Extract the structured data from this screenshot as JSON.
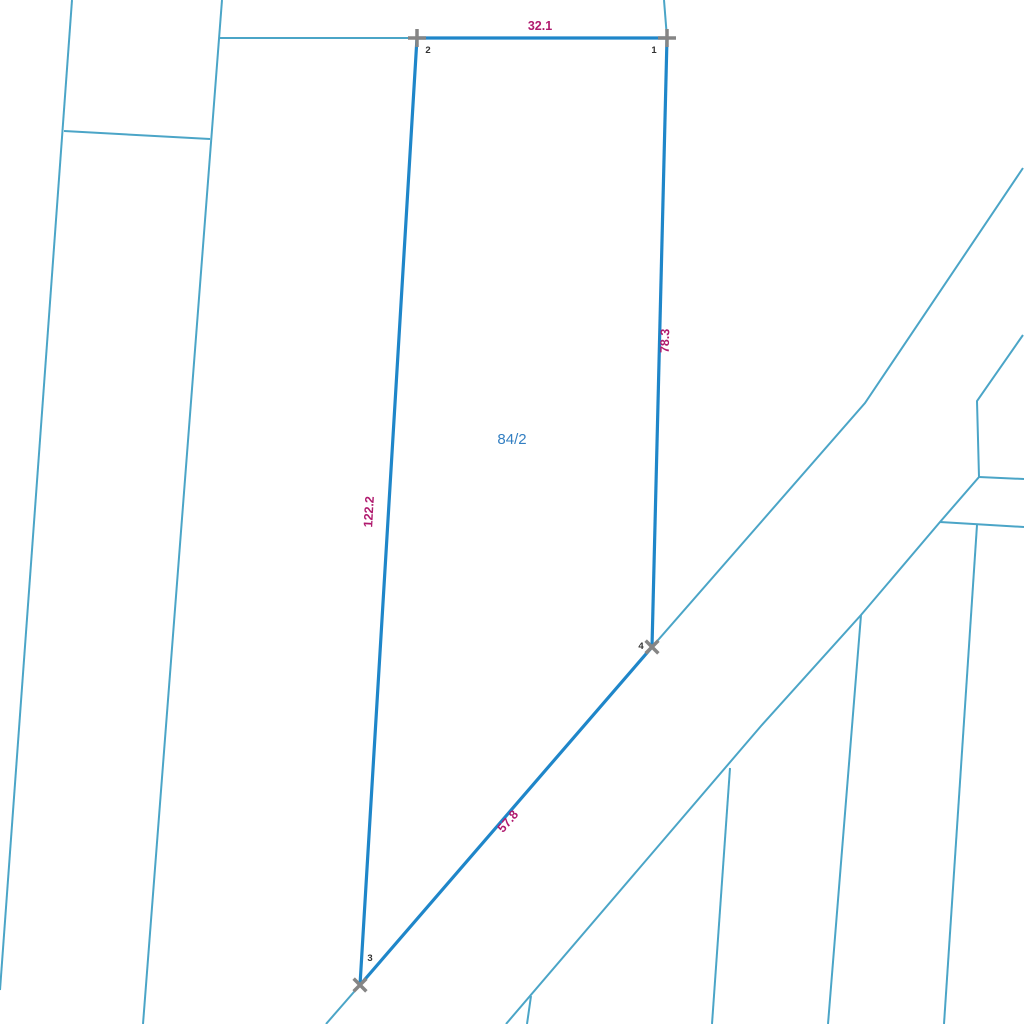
{
  "map": {
    "width": 1024,
    "height": 1024,
    "background_color": "#ffffff",
    "colors": {
      "parcel_edge": "#1f86c9",
      "cadastral_line": "#4ba5c7",
      "dimension_label": "#b01a6e",
      "parcel_number": "#337fc2",
      "vertex_marker": "#858585",
      "vertex_label": "#333333"
    },
    "stroke_widths": {
      "parcel_edge": 3.2,
      "cadastral_line": 2,
      "vertex_marker": 3.5
    },
    "parcel": {
      "number": "84/2",
      "number_label": {
        "x": 512,
        "y": 444
      },
      "vertices": [
        {
          "id": "1",
          "x": 667,
          "y": 38,
          "marker": "plus",
          "label_x": 654,
          "label_y": 53
        },
        {
          "id": "2",
          "x": 417,
          "y": 38,
          "marker": "plus",
          "label_x": 428,
          "label_y": 53
        },
        {
          "id": "3",
          "x": 360,
          "y": 985,
          "marker": "x",
          "label_x": 370,
          "label_y": 961
        },
        {
          "id": "4",
          "x": 652,
          "y": 647,
          "marker": "x",
          "label_x": 641,
          "label_y": 649
        }
      ],
      "edges": [
        {
          "from": "2",
          "to": "1",
          "length": "32.1",
          "label_x": 540,
          "label_y": 30,
          "label_rotation": 0
        },
        {
          "from": "1",
          "to": "4",
          "length": "78.3",
          "label_x": 669,
          "label_y": 341,
          "label_rotation": -88.6
        },
        {
          "from": "2",
          "to": "3",
          "length": "122.2",
          "label_x": 373,
          "label_y": 512,
          "label_rotation": -86.6
        },
        {
          "from": "3",
          "to": "4",
          "length": "57.8",
          "label_x": 511,
          "label_y": 824,
          "label_rotation": -49.2
        }
      ]
    },
    "cadastral_lines": [
      {
        "name": "boundary-line-west-outer",
        "points": [
          [
            72,
            0
          ],
          [
            0,
            990
          ]
        ]
      },
      {
        "name": "boundary-line-west-inner",
        "points": [
          [
            222,
            0
          ],
          [
            143,
            1024
          ]
        ]
      },
      {
        "name": "boundary-line-west-cross",
        "points": [
          [
            64,
            131
          ],
          [
            210,
            139
          ]
        ]
      },
      {
        "name": "boundary-line-north-extension",
        "points": [
          [
            219,
            38
          ],
          [
            417,
            38
          ]
        ]
      },
      {
        "name": "boundary-line-above-vertex-1",
        "points": [
          [
            664,
            0
          ],
          [
            667,
            38
          ]
        ]
      },
      {
        "name": "road-west-edge-south",
        "points": [
          [
            360,
            985
          ],
          [
            326,
            1024
          ]
        ]
      },
      {
        "name": "road-west-edge-north",
        "points": [
          [
            652,
            647
          ],
          [
            865,
            403
          ],
          [
            1023,
            168
          ]
        ]
      },
      {
        "name": "road-east-edge",
        "points": [
          [
            506,
            1024
          ],
          [
            761,
            726
          ],
          [
            861,
            615
          ],
          [
            940,
            522
          ],
          [
            979,
            477
          ],
          [
            977,
            401
          ],
          [
            1023,
            335
          ]
        ]
      },
      {
        "name": "boundary-line-east-1",
        "points": [
          [
            979,
            477
          ],
          [
            1024,
            479
          ]
        ]
      },
      {
        "name": "boundary-line-east-2",
        "points": [
          [
            940,
            522
          ],
          [
            1024,
            527
          ]
        ]
      },
      {
        "name": "boundary-line-southeast-1",
        "points": [
          [
            730,
            768
          ],
          [
            712,
            1024
          ]
        ]
      },
      {
        "name": "boundary-line-southeast-2",
        "points": [
          [
            861,
            615
          ],
          [
            828,
            1024
          ]
        ]
      },
      {
        "name": "boundary-line-southeast-3",
        "points": [
          [
            977,
            525
          ],
          [
            944,
            1024
          ]
        ]
      },
      {
        "name": "boundary-line-south-stub",
        "points": [
          [
            531,
            996
          ],
          [
            527,
            1024
          ]
        ]
      }
    ]
  }
}
